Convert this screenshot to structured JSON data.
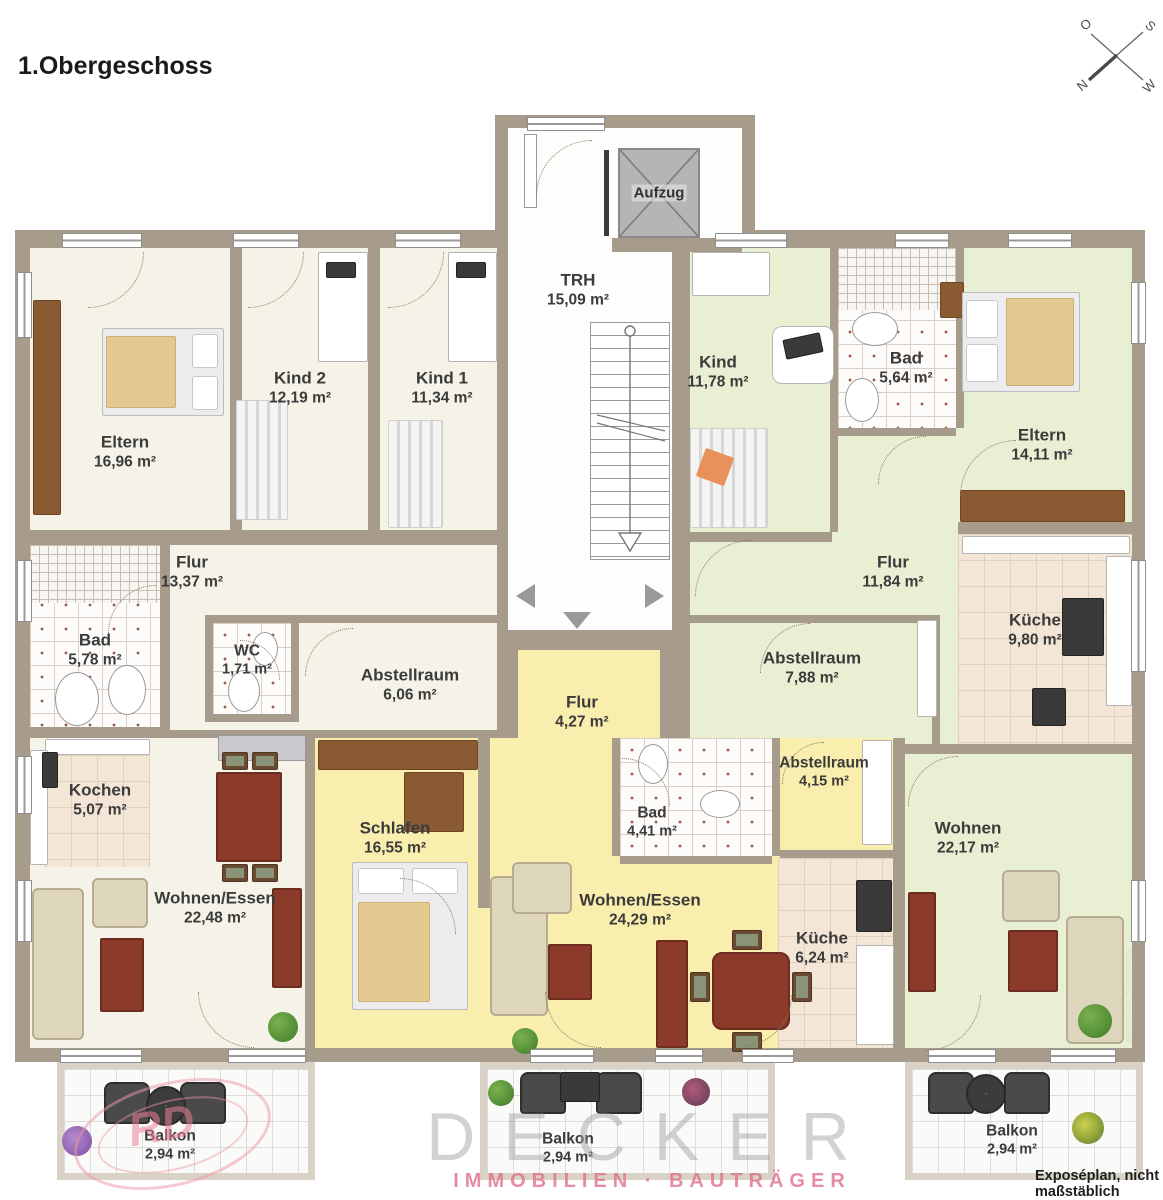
{
  "title": "1.Obergeschoss",
  "compass": {
    "o": "O",
    "s": "S",
    "n": "N",
    "w": "W"
  },
  "colors": {
    "wall": "#a79b8c",
    "floor_left_apartment": "#f5f3e7",
    "floor_middle_apartment": "#faeeae",
    "floor_right_apartment": "#e9efd2",
    "kitchen_tile": "#f3e6d7",
    "logo_accent": "#e0708a"
  },
  "rooms": {
    "trh": {
      "name": "TRH",
      "area": "15,09 m²"
    },
    "aufzug": {
      "name": "Aufzug"
    },
    "eltern_left": {
      "name": "Eltern",
      "area": "16,96 m²"
    },
    "kind2": {
      "name": "Kind 2",
      "area": "12,19 m²"
    },
    "kind1": {
      "name": "Kind 1",
      "area": "11,34 m²"
    },
    "flur_left": {
      "name": "Flur",
      "area": "13,37 m²"
    },
    "bad_left": {
      "name": "Bad",
      "area": "5,78 m²"
    },
    "wc": {
      "name": "WC",
      "area": "1,71 m²"
    },
    "abstellraum_left": {
      "name": "Abstellraum",
      "area": "6,06 m²"
    },
    "kochen": {
      "name": "Kochen",
      "area": "5,07 m²"
    },
    "wohnen_essen_left": {
      "name": "Wohnen/Essen",
      "area": "22,48 m²"
    },
    "schlafen": {
      "name": "Schlafen",
      "area": "16,55 m²"
    },
    "flur_middle": {
      "name": "Flur",
      "area": "4,27 m²"
    },
    "bad_middle": {
      "name": "Bad",
      "area": "4,41 m²"
    },
    "abstellraum_middle": {
      "name": "Abstellraum",
      "area": "4,15 m²"
    },
    "wohnen_essen_middle": {
      "name": "Wohnen/Essen",
      "area": "24,29 m²"
    },
    "kueche_middle": {
      "name": "Küche",
      "area": "6,24 m²"
    },
    "kind_right": {
      "name": "Kind",
      "area": "11,78 m²"
    },
    "bad_right": {
      "name": "Bad",
      "area": "5,64 m²"
    },
    "eltern_right": {
      "name": "Eltern",
      "area": "14,11 m²"
    },
    "flur_right": {
      "name": "Flur",
      "area": "11,84 m²"
    },
    "kueche_right": {
      "name": "Küche",
      "area": "9,80 m²"
    },
    "abstellraum_right": {
      "name": "Abstellraum",
      "area": "7,88 m²"
    },
    "wohnen_right": {
      "name": "Wohnen",
      "area": "22,17 m²"
    },
    "balkon_left": {
      "name": "Balkon",
      "area": "2,94 m²"
    },
    "balkon_middle": {
      "name": "Balkon",
      "area": "2,94 m²"
    },
    "balkon_right": {
      "name": "Balkon",
      "area": "2,94 m²"
    }
  },
  "branding": {
    "logo_initials": "RD",
    "company": "DECKER",
    "tagline": "IMMOBILIEN · BAUTRÄGER"
  },
  "notes": {
    "scale_note": "Exposéplan, nicht maßstäblich",
    "credit": "Illustration©ImmoGrafik"
  }
}
